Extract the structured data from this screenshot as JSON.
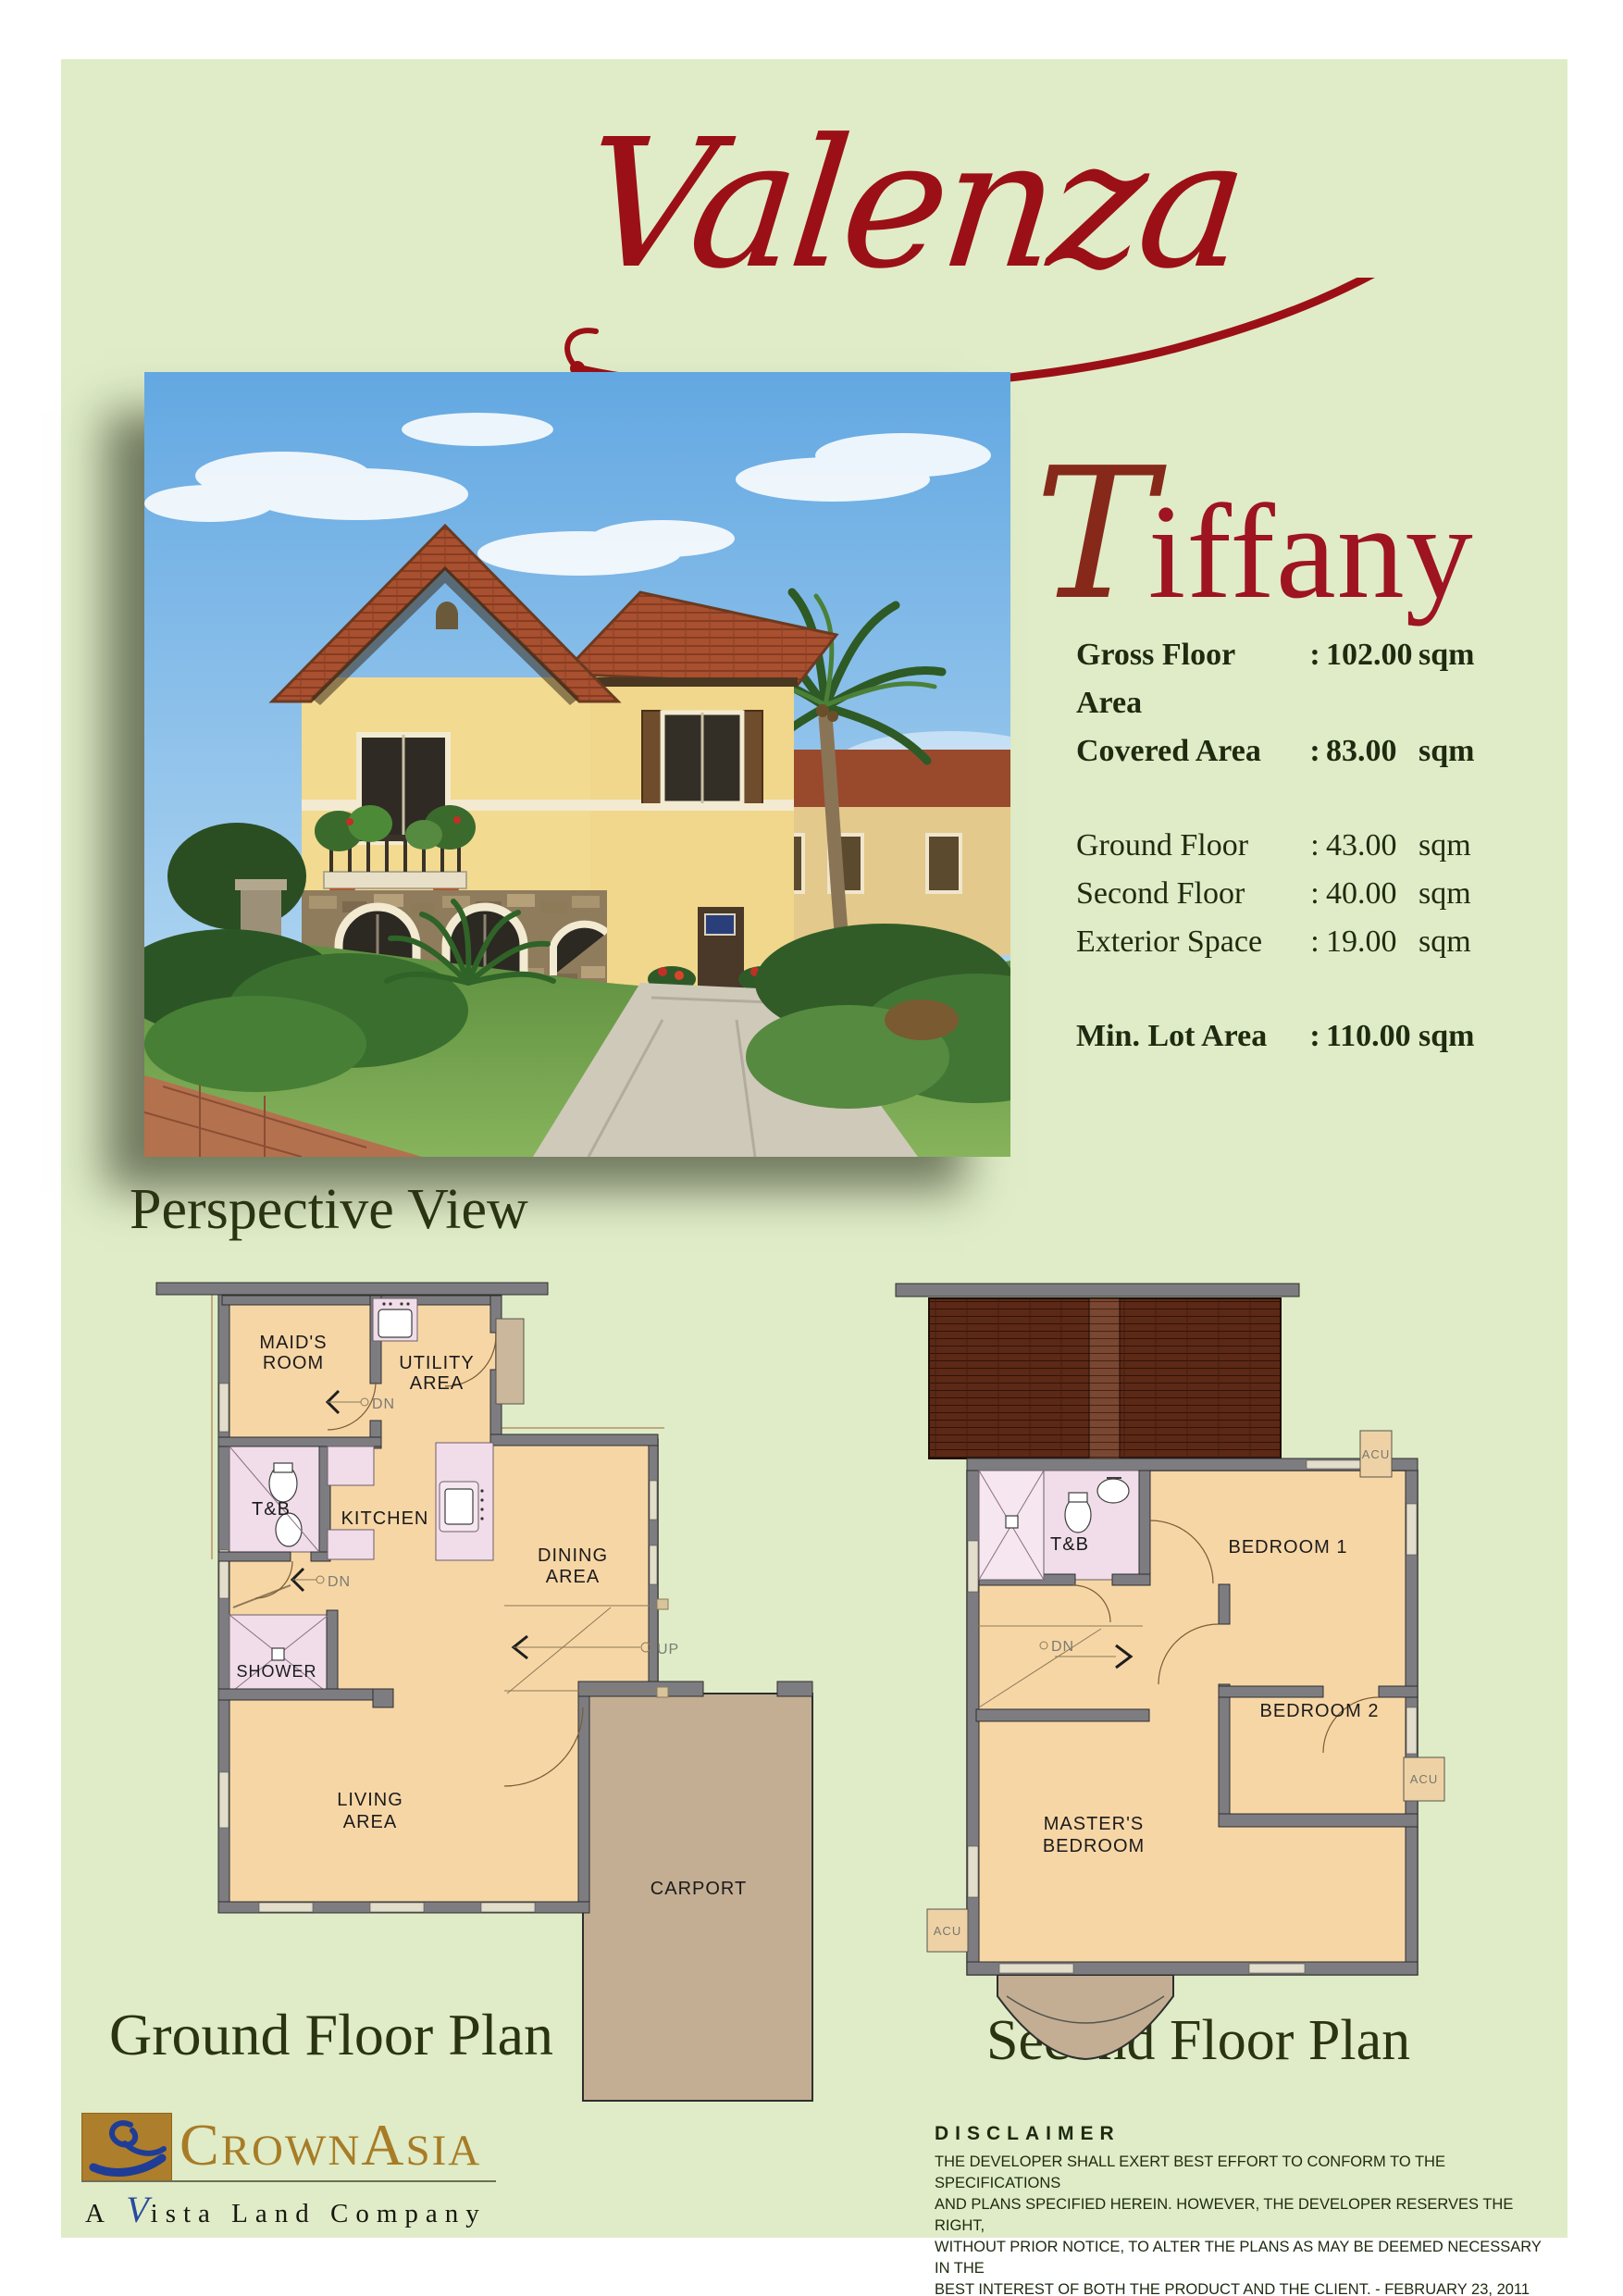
{
  "title": "Valenza",
  "model": {
    "initial": "T",
    "rest": "iffany",
    "name": "Tiffany"
  },
  "specs": {
    "rows": [
      {
        "label": "Gross Floor Area",
        "colon": ":",
        "value": "102.00",
        "unit": "sqm"
      },
      {
        "label": "Covered Area",
        "colon": ":",
        "value": "83.00",
        "unit": "sqm"
      },
      {
        "label": "Ground Floor",
        "colon": ":",
        "value": "43.00",
        "unit": "sqm"
      },
      {
        "label": "Second Floor",
        "colon": ":",
        "value": "40.00",
        "unit": "sqm"
      },
      {
        "label": "Exterior Space",
        "colon": ":",
        "value": "19.00",
        "unit": "sqm"
      },
      {
        "label": "Min. Lot Area",
        "colon": ":",
        "value": "110.00",
        "unit": "sqm"
      }
    ]
  },
  "captions": {
    "perspective": "Perspective View",
    "ground": "Ground Floor Plan",
    "second": "Second Floor Plan"
  },
  "ground_plan": {
    "labels": {
      "maids1": "MAID'S",
      "maids2": "ROOM",
      "utility1": "UTILITY",
      "utility2": "AREA",
      "tb": "T&B",
      "kitchen": "KITCHEN",
      "dining1": "DINING",
      "dining2": "AREA",
      "shower": "SHOWER",
      "living1": "LIVING",
      "living2": "AREA",
      "carport": "CARPORT",
      "dn": "DN",
      "up": "UP"
    }
  },
  "second_plan": {
    "labels": {
      "tb": "T&B",
      "bedroom1": "BEDROOM 1",
      "bedroom2": "BEDROOM 2",
      "masters1": "MASTER'S",
      "masters2": "BEDROOM",
      "dn": "DN",
      "acu": "ACU"
    }
  },
  "logo": {
    "c": "C",
    "rown": "ROWN",
    "a": "A",
    "sia": "SIA",
    "tag_a": "A",
    "tag_v": "V",
    "tag_rest": "ista Land Company"
  },
  "disclaimer": {
    "title": "DISCLAIMER",
    "lines": [
      "THE DEVELOPER SHALL EXERT BEST EFFORT TO CONFORM TO THE SPECIFICATIONS",
      "AND PLANS SPECIFIED HEREIN. HOWEVER, THE DEVELOPER RESERVES THE RIGHT,",
      "WITHOUT PRIOR NOTICE, TO ALTER THE PLANS AS MAY BE DEEMED NECESSARY IN THE",
      "BEST INTEREST OF BOTH THE PRODUCT AND THE CLIENT.  -  FEBRUARY 23, 2011"
    ]
  },
  "colors": {
    "page_bg": "#dfecc7",
    "accent_red": "#9b1016",
    "text_dark_green": "#1e2b10",
    "logo_gold": "#a87c26",
    "logo_blue": "#2a4a9c",
    "plan_wall_gray": "#7d7d81",
    "plan_floor_peach": "#f7d6a6",
    "plan_fixture_pink": "#f0dde9",
    "plan_carport_tan": "#c3ae93",
    "plan_roof_brown": "#5c2916"
  }
}
